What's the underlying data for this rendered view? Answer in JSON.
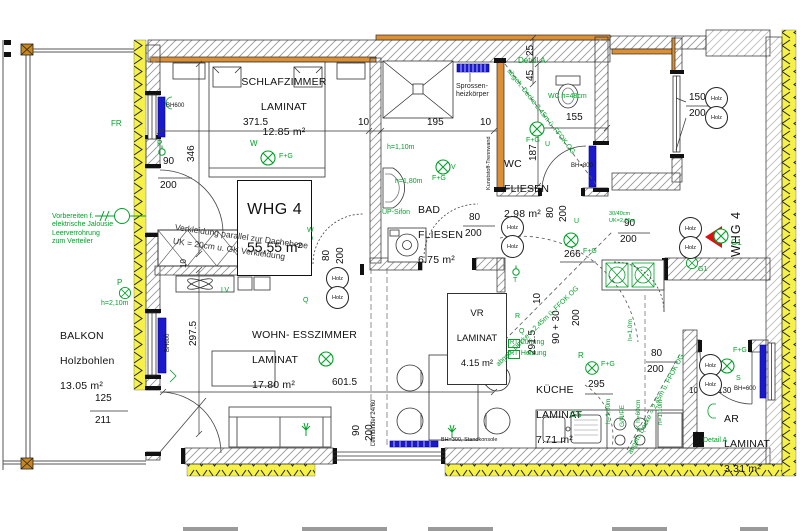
{
  "apartment": {
    "name": "WHG 4",
    "area": "55,55 m²",
    "entry_label": "WHG 4"
  },
  "rooms": {
    "schlafzimmer": {
      "name": "SCHLAFZIMMER",
      "floor": "LAMINAT",
      "area": "12.85 m²"
    },
    "bad": {
      "name": "BAD",
      "floor": "FLIESEN",
      "area": "6.75 m²"
    },
    "wc": {
      "name": "WC",
      "floor": "FLIESEN",
      "area": "2.98 m²"
    },
    "vr": {
      "name": "VR",
      "floor": "LAMINAT",
      "area": "4.15 m²"
    },
    "wohn_esszimmer": {
      "name": "WOHN- ESSZIMMER",
      "floor": "LAMINAT",
      "area": "17.80 m²"
    },
    "kueche": {
      "name": "KÜCHE",
      "floor": "LAMINAT",
      "area": "7.71 m²"
    },
    "ar": {
      "name": "AR",
      "floor": "LAMINAT",
      "area": "3.31 m²"
    },
    "balkon": {
      "name": "BALKON",
      "floor": "Holzbohlen",
      "area": "13.05 m²"
    }
  },
  "dimensions": {
    "schlaf_breite": "371.5",
    "zehn_a": "10",
    "bad_breite": "195",
    "zehn_b": "10",
    "wc_breite": "155",
    "v25": "25",
    "v45": "45",
    "wc_tiefe": "187",
    "schlaf_tiefe": "346",
    "wohn_tiefe": "297.5",
    "wohn_breite": "601.5",
    "flur_breite": "291.5",
    "flur_a": "90 + 30",
    "flur_b": "200",
    "zehn_c": "10",
    "zehn_d": "10",
    "d266": "266",
    "kueche_breite": "295",
    "balkontuer_b": "125",
    "balkontuer_h": "211",
    "ar_a": "10",
    "ar_b": "130"
  },
  "doors": {
    "schlafzimmer": {
      "b": "90",
      "h": "200"
    },
    "bad": {
      "b": "80",
      "h": "200"
    },
    "wc": {
      "b": "80",
      "h": "200"
    },
    "korridor": {
      "b": "80",
      "h": "200"
    },
    "eingang": {
      "b": "90",
      "h": "200"
    },
    "ar": {
      "b": "80",
      "h": "200"
    },
    "fenster_wohn": {
      "b": "90",
      "h": "200"
    },
    "stiegenfenster": {
      "b": "150",
      "h": "200"
    },
    "material": "Holz"
  },
  "heizkoerper": {
    "bh600_a": "BH600",
    "bh600_b": "BH600",
    "bh800": "BH=800",
    "bh600_ar": "BH=600",
    "standkonsole": "BH=300, Standkonsole",
    "sprossen": "Sprossen-\nheizkörper"
  },
  "annotations": {
    "jalousie": "Vorbereiten f.\nelektrische Jalousie\nLeerverrohrung\nzum Verteiler",
    "verkleidung": "Verkleidung parallel zur Dachebene\nUK = 20cm u. GK Verkleidung",
    "decke_wc": "abgeh. Decke 2,45m ü. FFOK OG",
    "decke_flur": "abgeh. Decke = 2,45m ü. FFOK OG",
    "decke_kueche": "abgeh. Decke = 2,45m ü. FFOK OG",
    "kunststoff": "Kunststoff-Trennwand",
    "leimbinder": "Leimbinder 24/60",
    "detail_a": "Detail A",
    "wc_hocke": "WC h=48cm",
    "h110": "h=1,10m",
    "h180": "h=1,80m",
    "up_sifon": "UP-Sifon",
    "h210": "h=2,10m",
    "h110_k": "h=1,10m",
    "h180_k": "h=1,80m",
    "gnpe": "G/N/PE",
    "kh60": "K h=60cm",
    "h10": "h=1,0m",
    "rt": "RT",
    "lueftung": "Lüftung",
    "heizung": "Heizung",
    "gs": "GS",
    "uk1": "30/40cm",
    "uk2": "UK=2,05m"
  },
  "switches": {
    "fr": "FR",
    "p": "P",
    "w": "W",
    "q": "Q",
    "v": "V",
    "u": "U",
    "r": "R",
    "s": "S",
    "t": "T",
    "lv": "LV",
    "g1": "G1",
    "fg": "F+G"
  },
  "colors": {
    "wall_orange": "#dd8f33",
    "insulation_yellow": "#f5f148",
    "radiator_blue": "#1a1acc",
    "annotation_green": "#00a228",
    "entry_red": "#dd1111"
  }
}
